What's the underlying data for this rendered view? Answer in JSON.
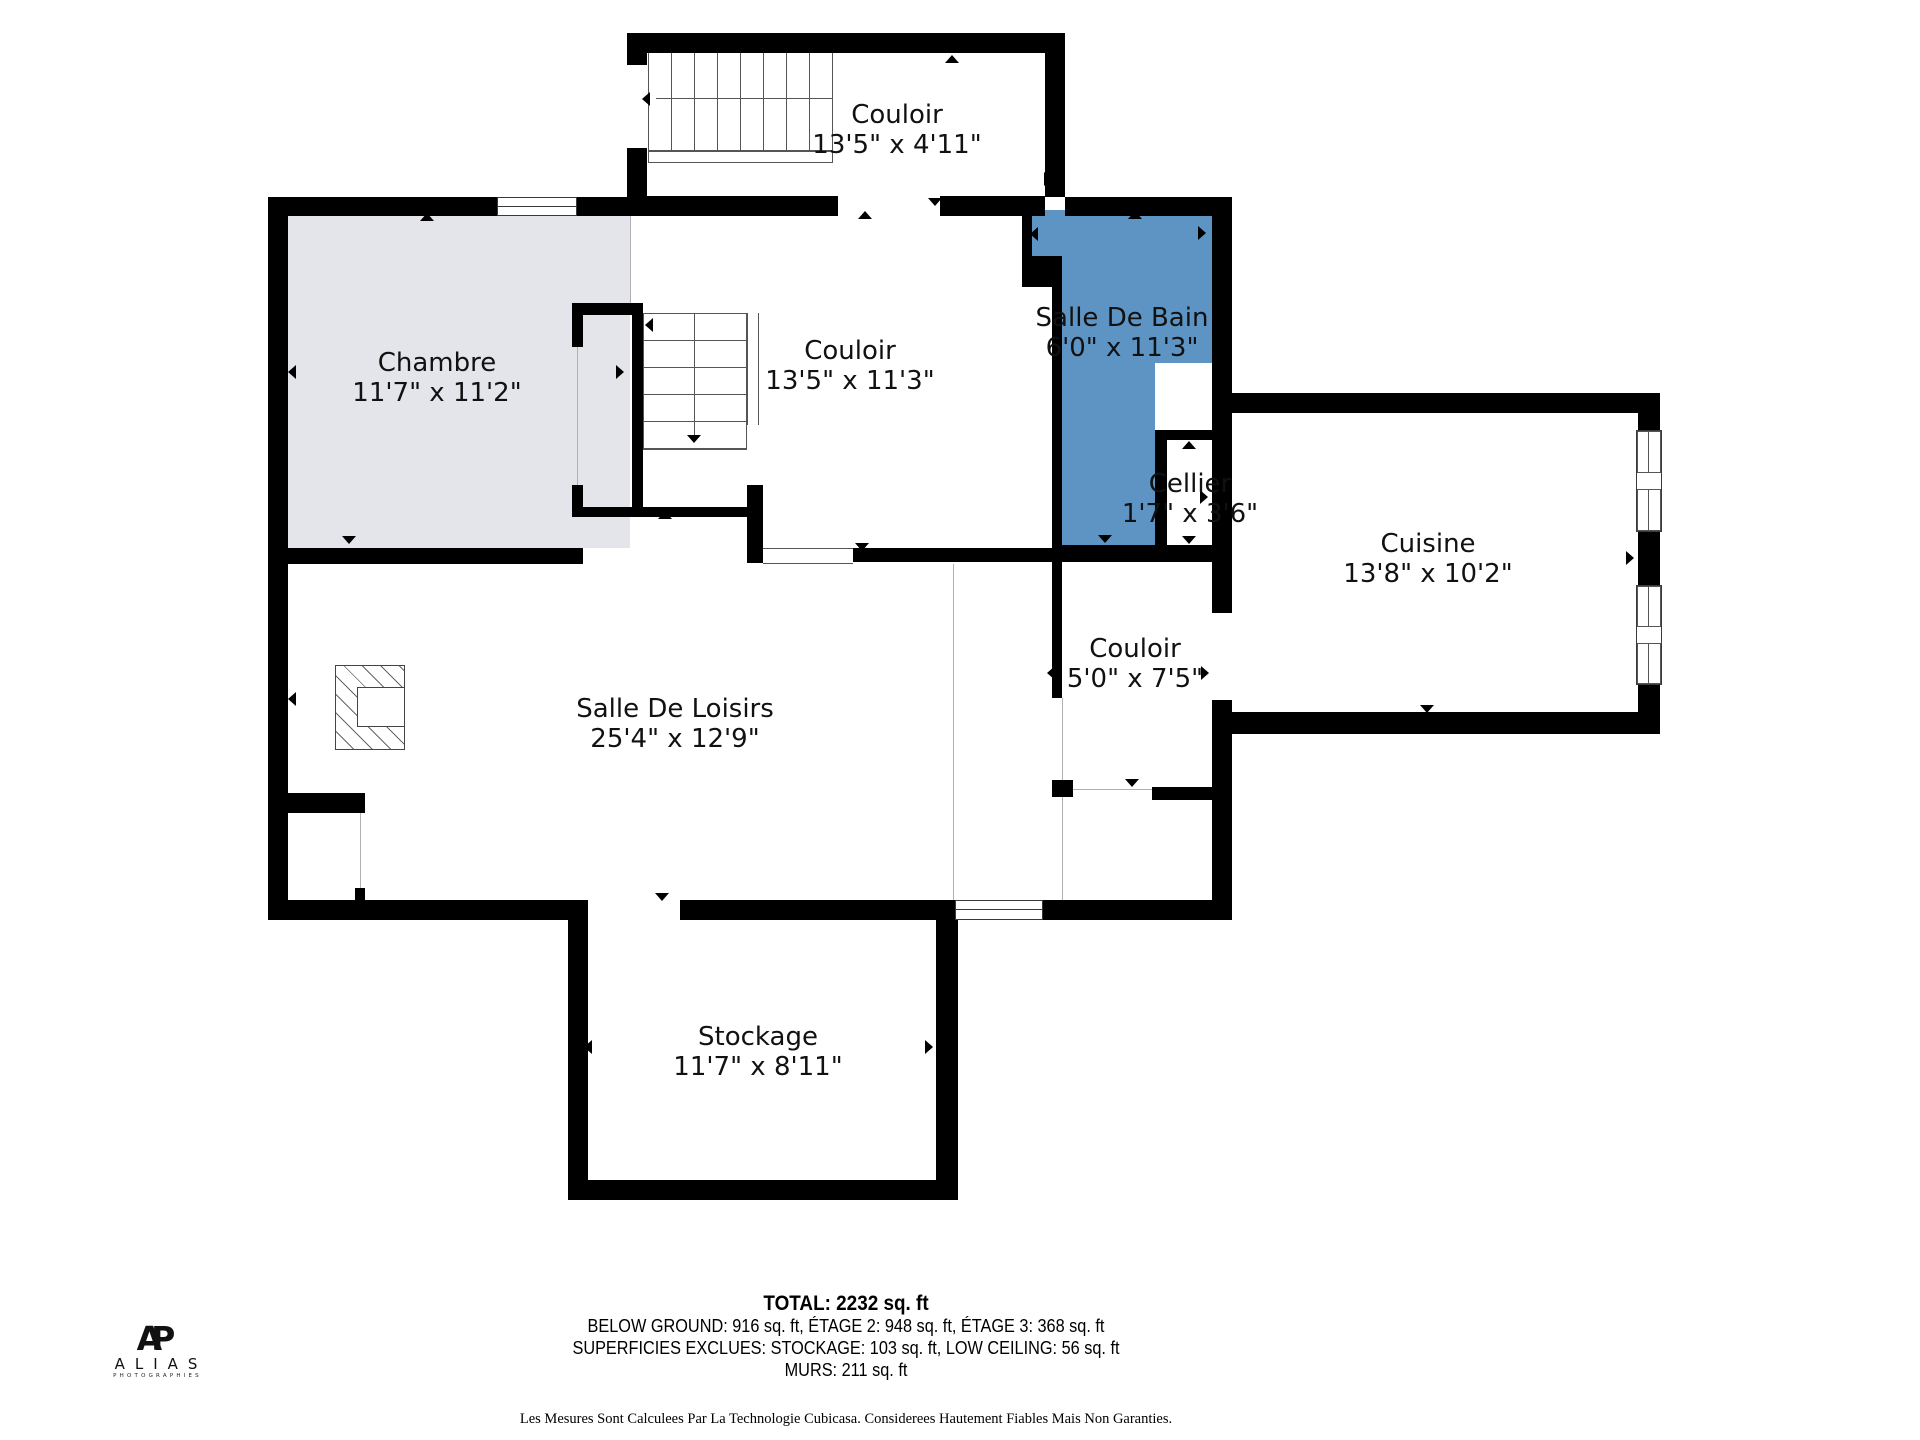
{
  "rooms": [
    {
      "id": "couloir-haut",
      "name": "Couloir",
      "dims": "13'5\" x 4'11\""
    },
    {
      "id": "chambre",
      "name": "Chambre",
      "dims": "11'7\" x 11'2\""
    },
    {
      "id": "couloir-milieu",
      "name": "Couloir",
      "dims": "13'5\" x 11'3\""
    },
    {
      "id": "salle-de-bain",
      "name": "Salle De Bain",
      "dims": "6'0\" x 11'3\""
    },
    {
      "id": "cellier",
      "name": "Cellier",
      "dims": "1'7\" x 3'6\""
    },
    {
      "id": "cuisine",
      "name": "Cuisine",
      "dims": "13'8\" x 10'2\""
    },
    {
      "id": "couloir-bas",
      "name": "Couloir",
      "dims": "5'0\" x 7'5\""
    },
    {
      "id": "salle-de-loisirs",
      "name": "Salle De Loisirs",
      "dims": "25'4\" x 12'9\""
    },
    {
      "id": "stockage",
      "name": "Stockage",
      "dims": "11'7\" x 8'11\""
    }
  ],
  "footer": {
    "total": "TOTAL: 2232 sq. ft",
    "line1": "BELOW GROUND: 916 sq. ft, ÉTAGE 2: 948 sq. ft, ÉTAGE 3: 368 sq. ft",
    "line2": "SUPERFICIES EXCLUES: STOCKAGE: 103 sq. ft, LOW CEILING: 56 sq. ft",
    "line3": "MURS: 211 sq. ft",
    "disclaimer": "Les Mesures Sont Calculees Par La Technologie Cubicasa. Considerees Hautement Fiables Mais Non Garanties."
  },
  "logo": {
    "monogram": "AP",
    "name": "ALIAS",
    "tagline": "PHOTOGRAPHIES"
  },
  "colors": {
    "wall": "#000000",
    "bathroom_blue": "#5d94c4",
    "bedroom_gray": "#e3e5ea"
  }
}
